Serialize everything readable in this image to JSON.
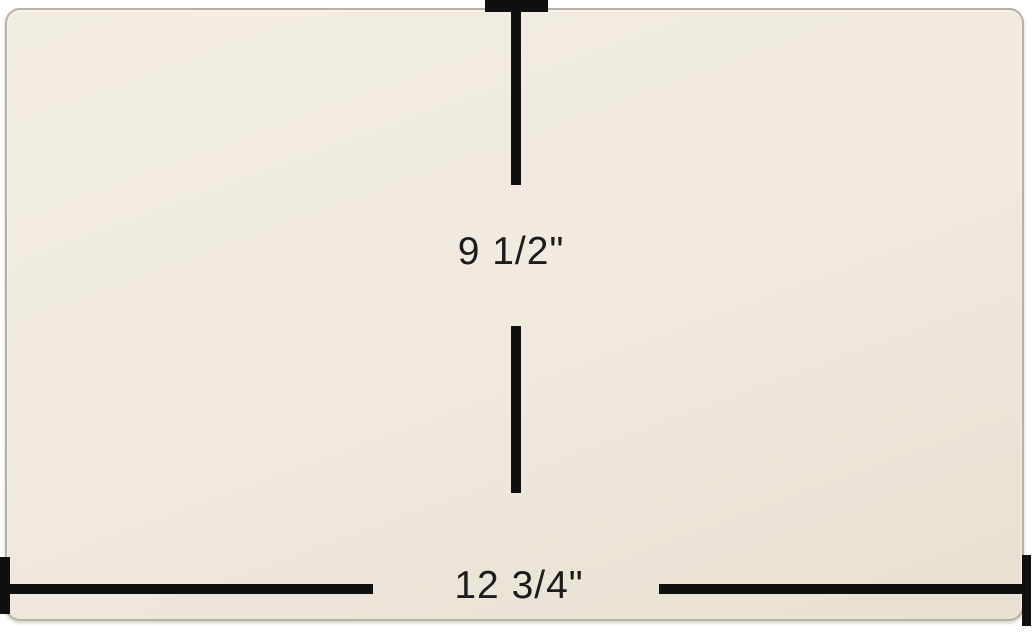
{
  "image": {
    "description": "Cream rectangular glass panel shown with measurement lines",
    "background_color": "#ffffff"
  },
  "panel": {
    "object": "glass panel",
    "fill_top": "#f2ede3",
    "fill_mid": "#efe9de",
    "fill_bottom": "#e7e1d3",
    "edge_color": "rgba(154, 146, 130, 0.65)"
  },
  "dimensions": {
    "line_color": "#101010",
    "text_color": "#1c1c1c",
    "height": {
      "label": "9 1/2\""
    },
    "width": {
      "label": "12 3/4\""
    }
  }
}
